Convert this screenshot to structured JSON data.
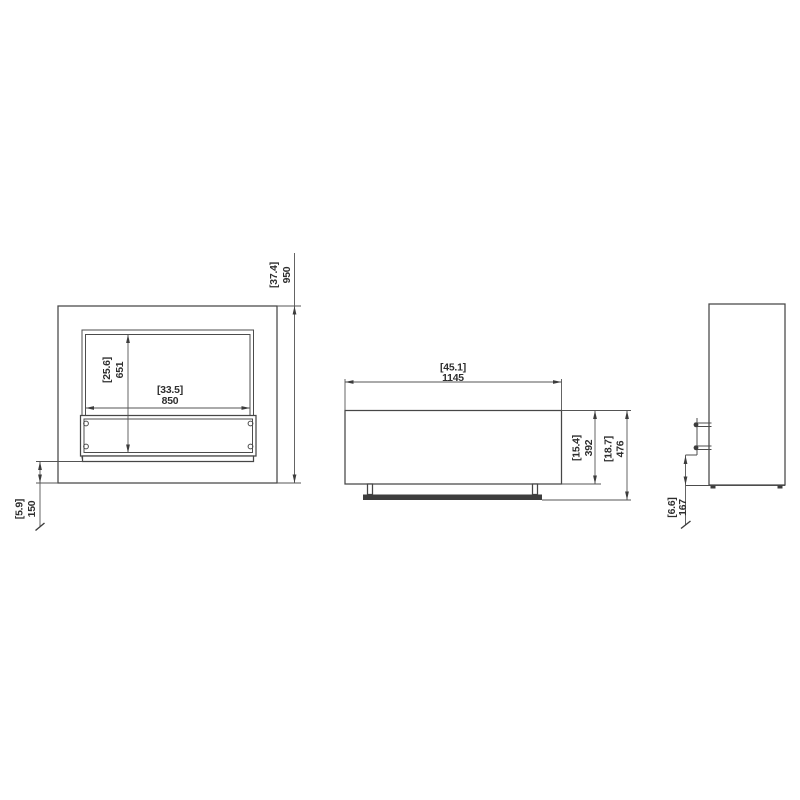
{
  "colors": {
    "background": "#ffffff",
    "line": "#464646",
    "text": "#2e2e2e"
  },
  "front_view": {
    "overall_height": {
      "inches": "[37.4]",
      "mm": "950"
    },
    "opening_height": {
      "inches": "[25.6]",
      "mm": "651"
    },
    "opening_width": {
      "inches": "[33.5]",
      "mm": "850"
    },
    "plinth_height": {
      "inches": "[5.9]",
      "mm": "150"
    }
  },
  "burner_view": {
    "width": {
      "inches": "[45.1]",
      "mm": "1145"
    },
    "body_height": {
      "inches": "[15.4]",
      "mm": "392"
    },
    "overall_height": {
      "inches": "[18.7]",
      "mm": "476"
    }
  },
  "side_view": {
    "base_offset": {
      "inches": "[6.6]",
      "mm": "167"
    }
  }
}
